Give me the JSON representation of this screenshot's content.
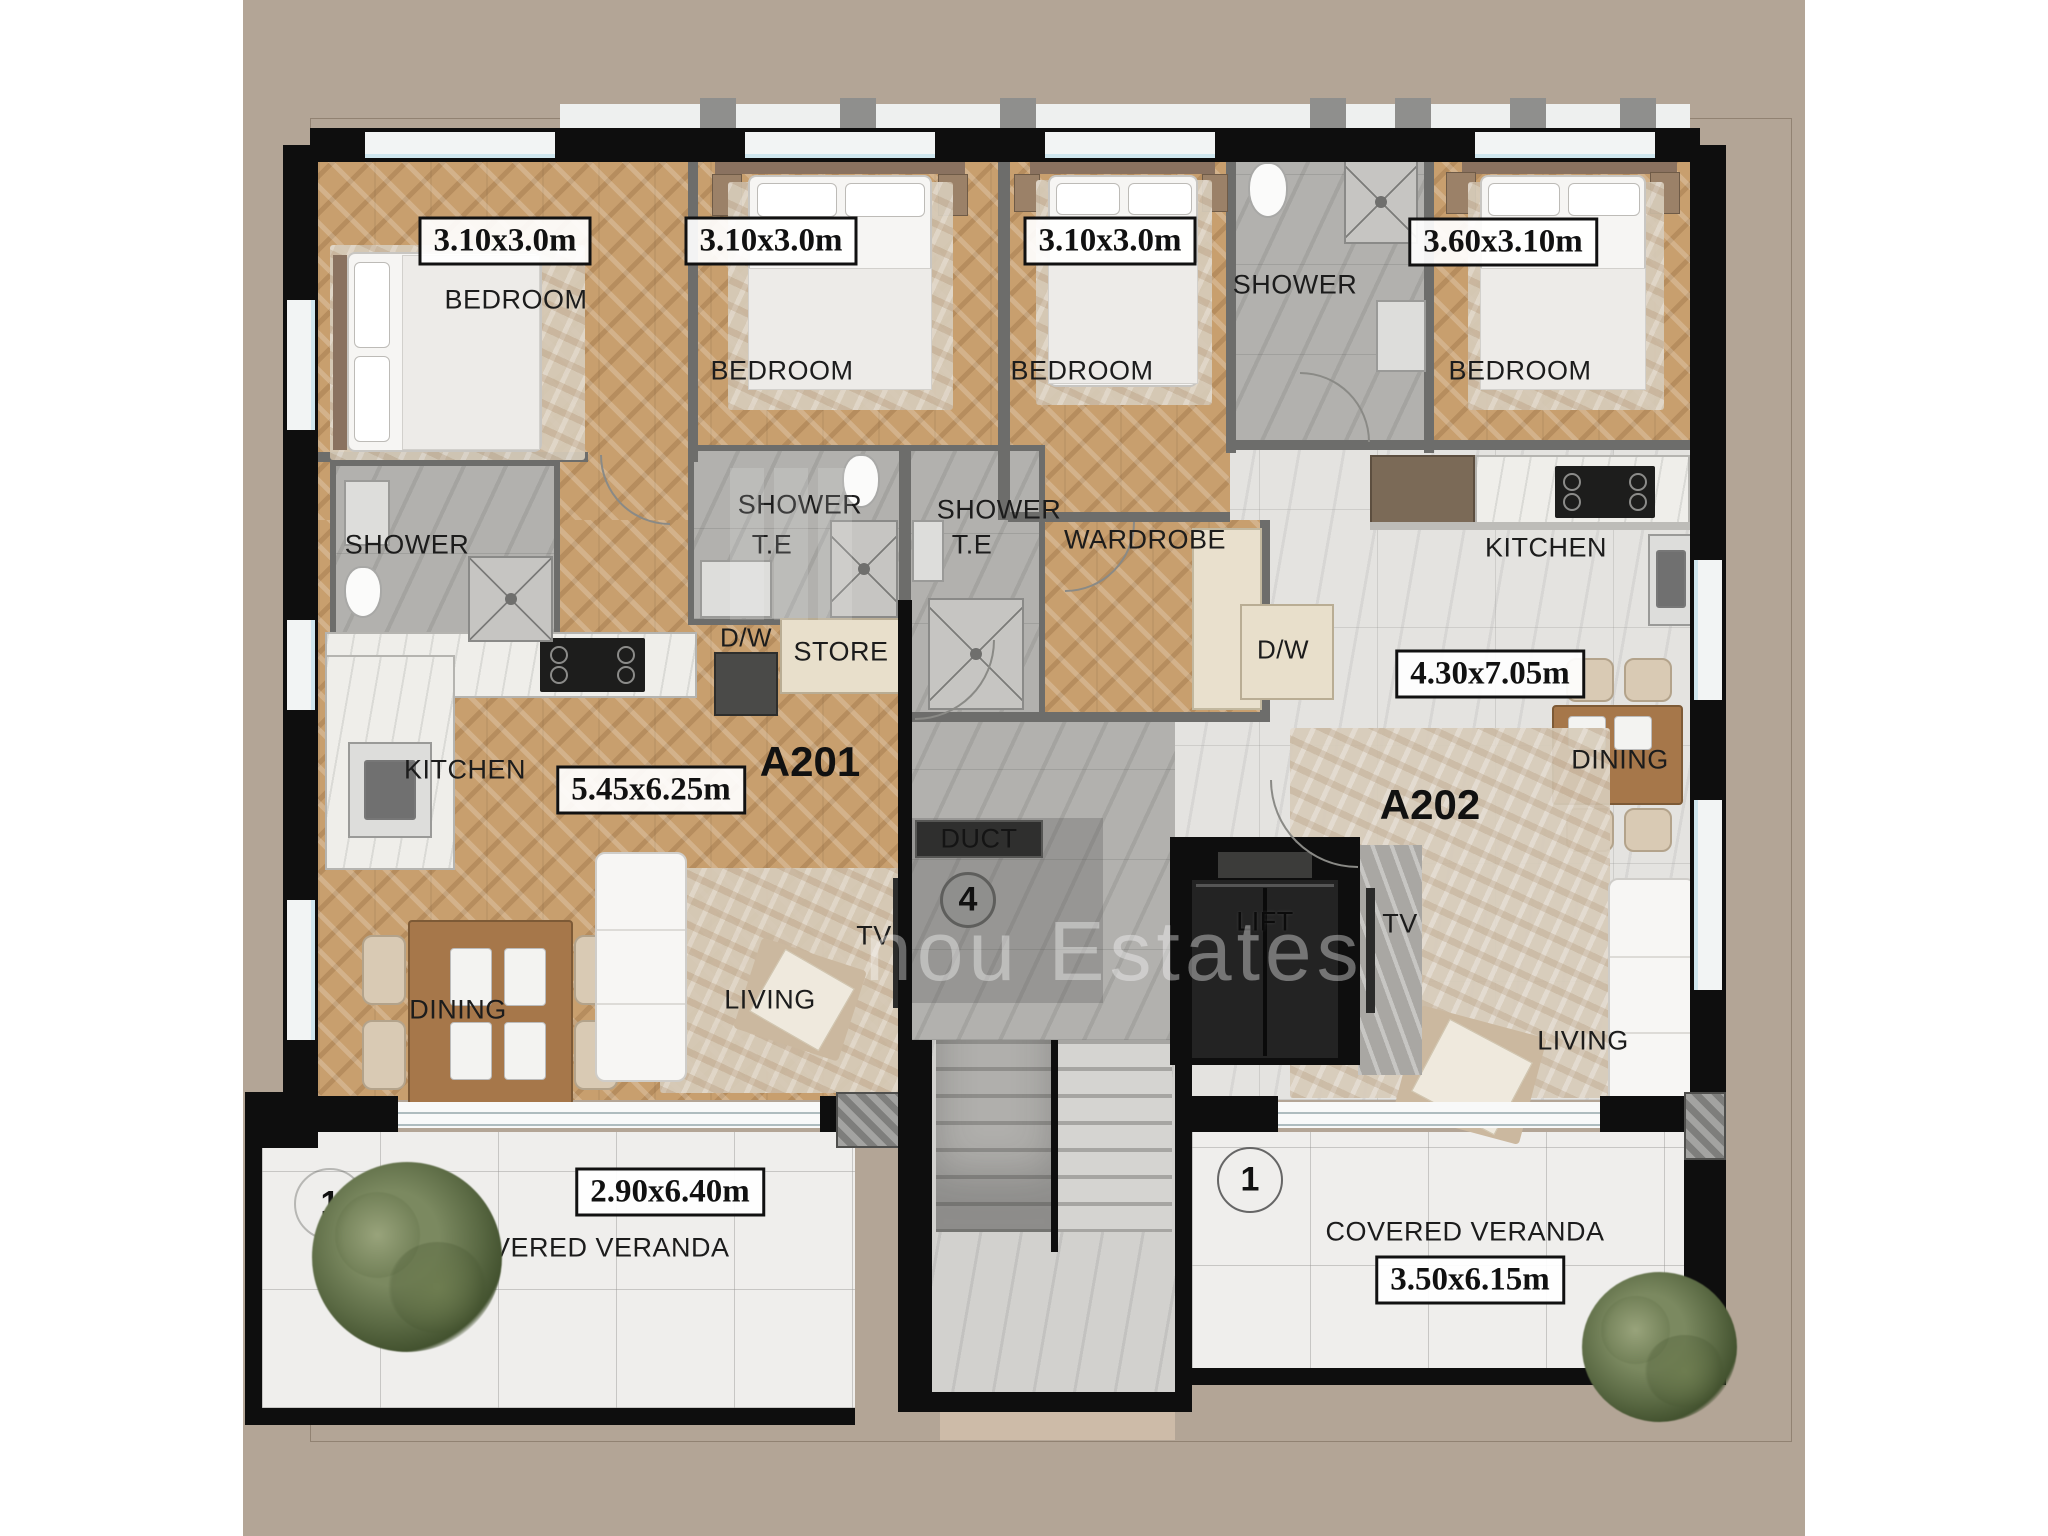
{
  "watermark": "nou Estates",
  "apartments": {
    "left_id": "A201",
    "right_id": "A202"
  },
  "rooms": {
    "bedroom1": {
      "name": "BEDROOM",
      "dim": "3.10x3.0m"
    },
    "bedroom2": {
      "name": "BEDROOM",
      "dim": "3.10x3.0m"
    },
    "bedroom3": {
      "name": "BEDROOM",
      "dim": "3.10x3.0m"
    },
    "bedroom4": {
      "name": "BEDROOM",
      "dim": "3.60x3.10m"
    },
    "shower_left": {
      "name": "SHOWER"
    },
    "shower_te_1": {
      "name": "SHOWER",
      "sub": "T.E"
    },
    "shower_te_2": {
      "name": "SHOWER",
      "sub": "T.E"
    },
    "shower_top": {
      "name": "SHOWER"
    },
    "wardrobe": {
      "name": "WARDROBE"
    },
    "store": {
      "name": "STORE"
    },
    "duct": {
      "name": "DUCT"
    },
    "lift": {
      "name": "LIFT"
    },
    "kitchen_left": {
      "name": "KITCHEN"
    },
    "kitchen_right": {
      "name": "KITCHEN"
    },
    "dining_left": {
      "name": "DINING"
    },
    "dining_right": {
      "name": "DINING"
    },
    "living_left": {
      "name": "LIVING",
      "dim": "5.45x6.25m"
    },
    "living_right": {
      "name": "LIVING",
      "dim": "4.30x7.05m"
    },
    "veranda_left": {
      "name": "COVERED VERANDA",
      "dim": "2.90x6.40m",
      "marker": "1"
    },
    "veranda_right": {
      "name": "COVERED VERANDA",
      "dim": "3.50x6.15m",
      "marker": "1"
    },
    "dw_left": "D/W",
    "dw_right": "D/W",
    "tv_left": "TV",
    "tv_right": "TV",
    "core_marker": "4"
  },
  "colors": {
    "background": "#b3a596",
    "wall": "#0e0e0e",
    "wood_floor": "#c89f6e",
    "gray_tile": "#b2b1ae",
    "light_tile": "#e4e3e0",
    "veranda_tile": "#efeeec",
    "window_glazing": "#cfe6ee"
  }
}
